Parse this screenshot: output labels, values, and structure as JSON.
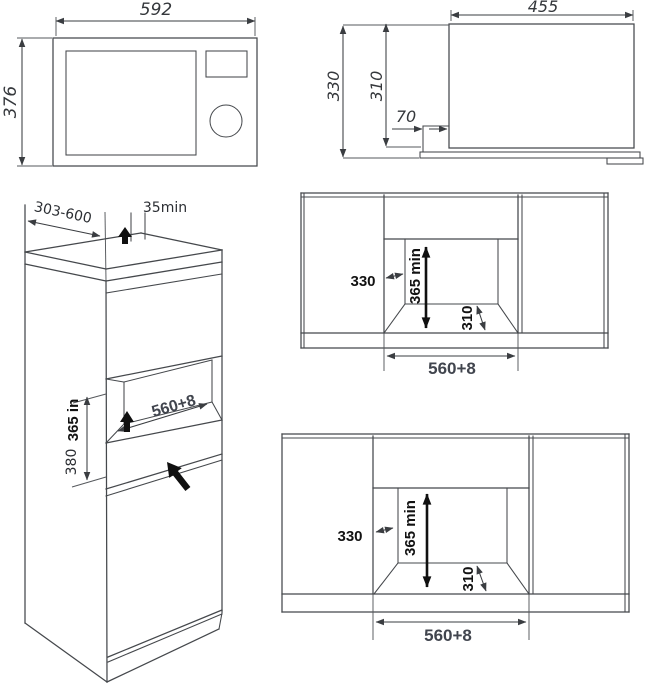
{
  "colors": {
    "ink": "#45484c",
    "label_ink": "#121212",
    "dim_ink": "#35383c",
    "width_dim_ink": "#41454e",
    "background": "#ffffff"
  },
  "views": {
    "front": {
      "width": "592",
      "height": "376"
    },
    "side": {
      "width": "455",
      "total_height": "330",
      "body_height": "310",
      "front_overhang": "70"
    },
    "cabinet": {
      "depth_range": "303-600",
      "rear_gap": "35min",
      "niche_width": "560+8",
      "niche_height": "365 in",
      "lower_niche_height": "380"
    },
    "niche_upper": {
      "wall_depth": "330",
      "min_height": "365 min",
      "shelf_depth": "310",
      "opening_width": "560+8"
    },
    "niche_lower": {
      "wall_depth": "330",
      "min_height": "365 min",
      "shelf_depth": "310",
      "opening_width": "560+8"
    }
  }
}
